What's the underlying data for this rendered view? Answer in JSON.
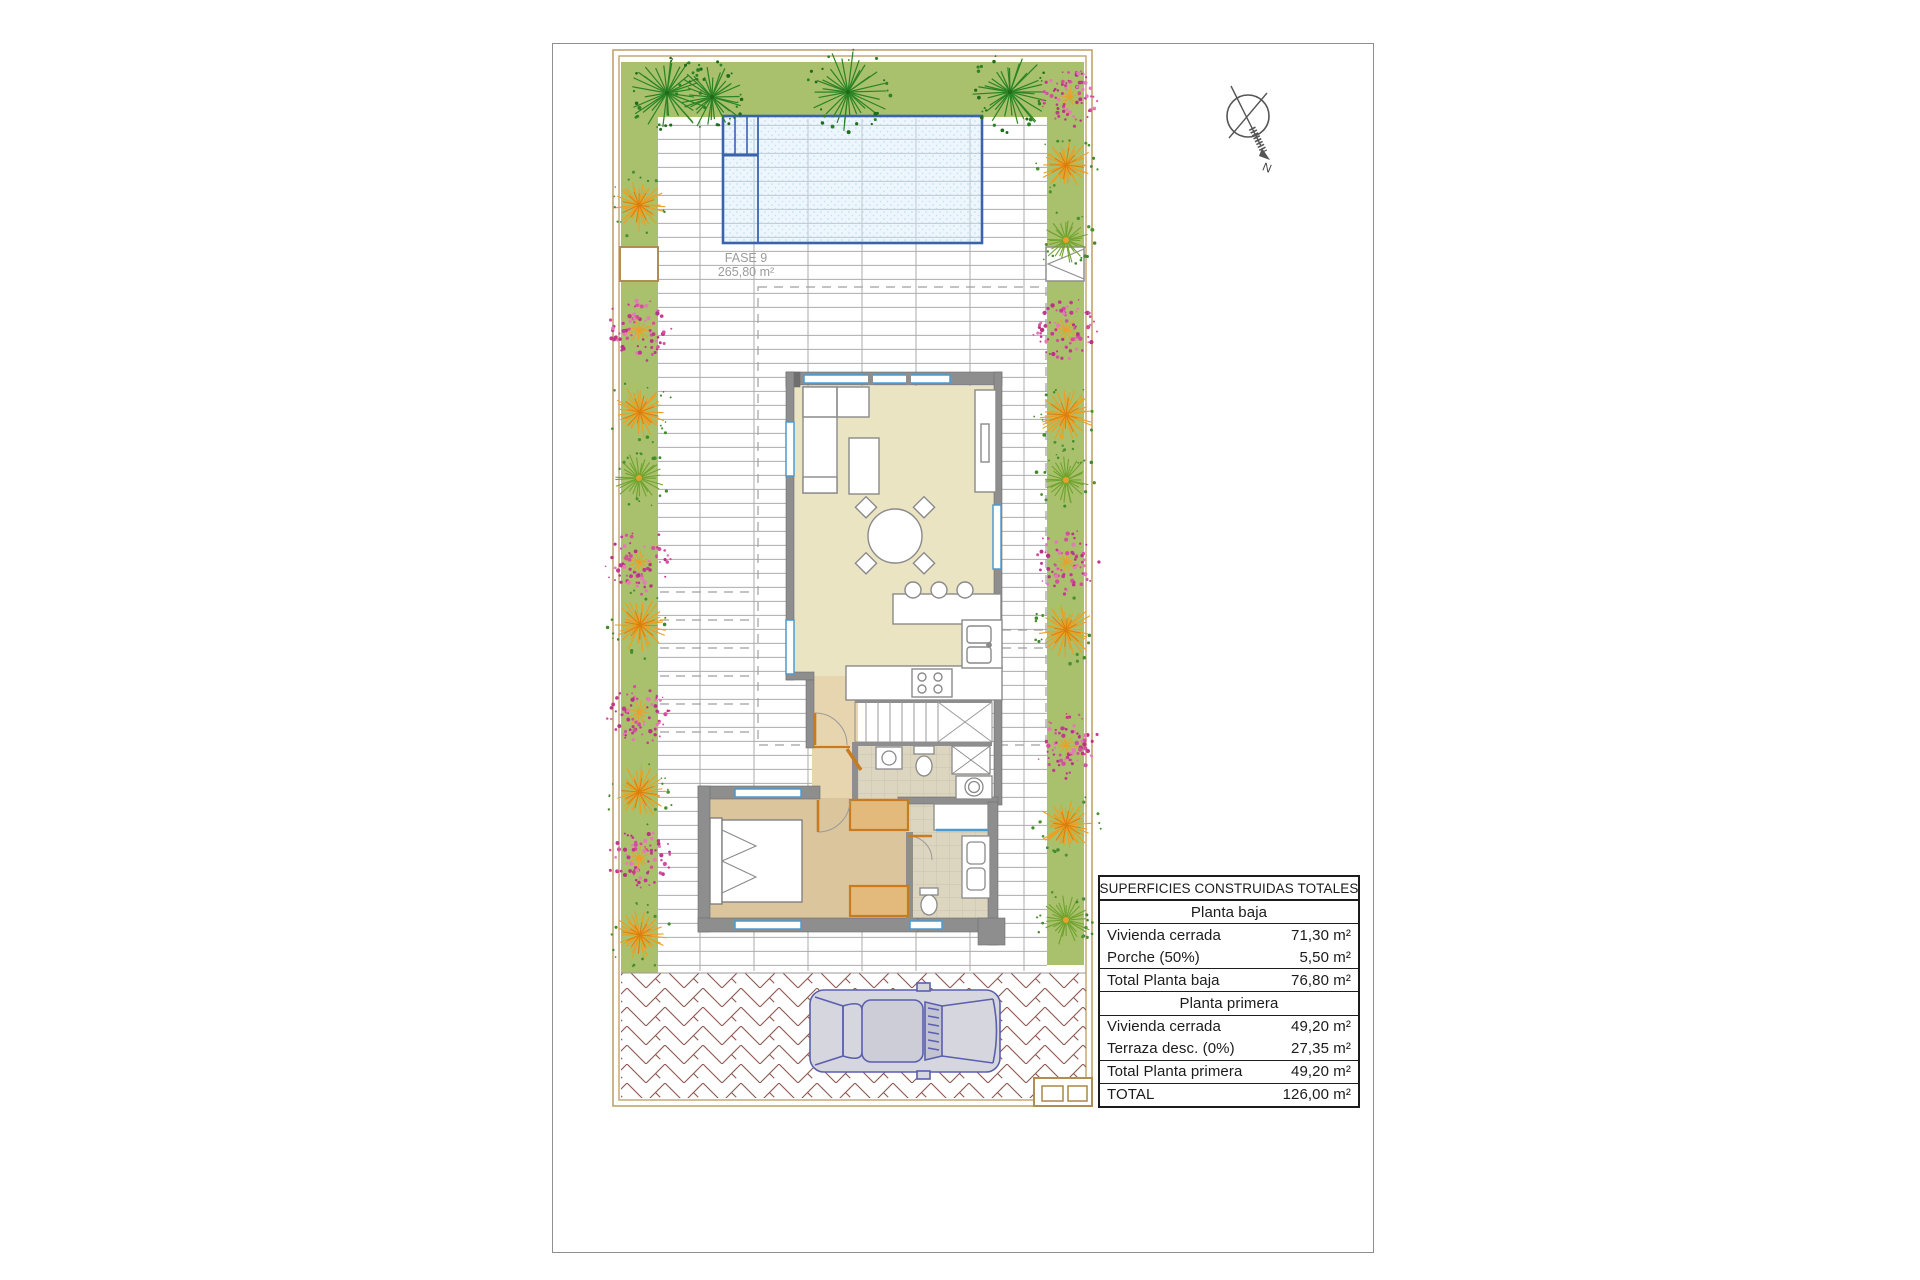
{
  "plan": {
    "fase_label_line1": "FASE 9",
    "fase_label_line2": "265,80 m²",
    "compass_letter": "N"
  },
  "areas_table": {
    "rows": [
      {
        "style": "header",
        "label": "SUPERFICIES CONSTRUIDAS TOTALES",
        "value": ""
      },
      {
        "style": "subheader",
        "label": "Planta baja",
        "value": ""
      },
      {
        "style": "data",
        "label": "Vivienda cerrada",
        "value": "71,30 m²"
      },
      {
        "style": "data",
        "label": "Porche (50%)",
        "value": "5,50 m²"
      },
      {
        "style": "total",
        "label": "Total Planta baja",
        "value": "76,80 m²"
      },
      {
        "style": "subheader",
        "label": "Planta primera",
        "value": ""
      },
      {
        "style": "data",
        "label": "Vivienda cerrada",
        "value": "49,20 m²"
      },
      {
        "style": "data",
        "label": "Terraza desc. (0%)",
        "value": "27,35 m²"
      },
      {
        "style": "total",
        "label": "Total Planta primera",
        "value": "49,20 m²"
      },
      {
        "style": "total",
        "label": "TOTAL",
        "value": "126,00 m²"
      }
    ]
  },
  "colors": {
    "garden_green": "#a9c06d",
    "tree_green": "#2c8326",
    "tree_green_dark": "#1e6b1a",
    "shrub_orange": "#f09d1e",
    "shrub_pink": "#d4509f",
    "shrub_leaf_green": "#4c9032",
    "pool_fill": "#d7ecf8",
    "pool_border": "#3a63ae",
    "wall_gray": "#8e8e8e",
    "floor_living": "#eae4c2",
    "floor_bedroom": "#dbc59d",
    "floor_tile": "#dcd5c0",
    "floor_hall": "#e6d5ae",
    "window_blue": "#4a9bd2",
    "carpentry_orange": "#c87b20",
    "wardrobe_fill": "#e3b97c",
    "paver_brown": "#8d564e",
    "car_blue": "#5a5fae",
    "car_body": "#d6d6de",
    "plot_border_tan": "#c2a36b",
    "deck_line_gray": "#ababab",
    "text_gray": "#9b9b9b"
  }
}
